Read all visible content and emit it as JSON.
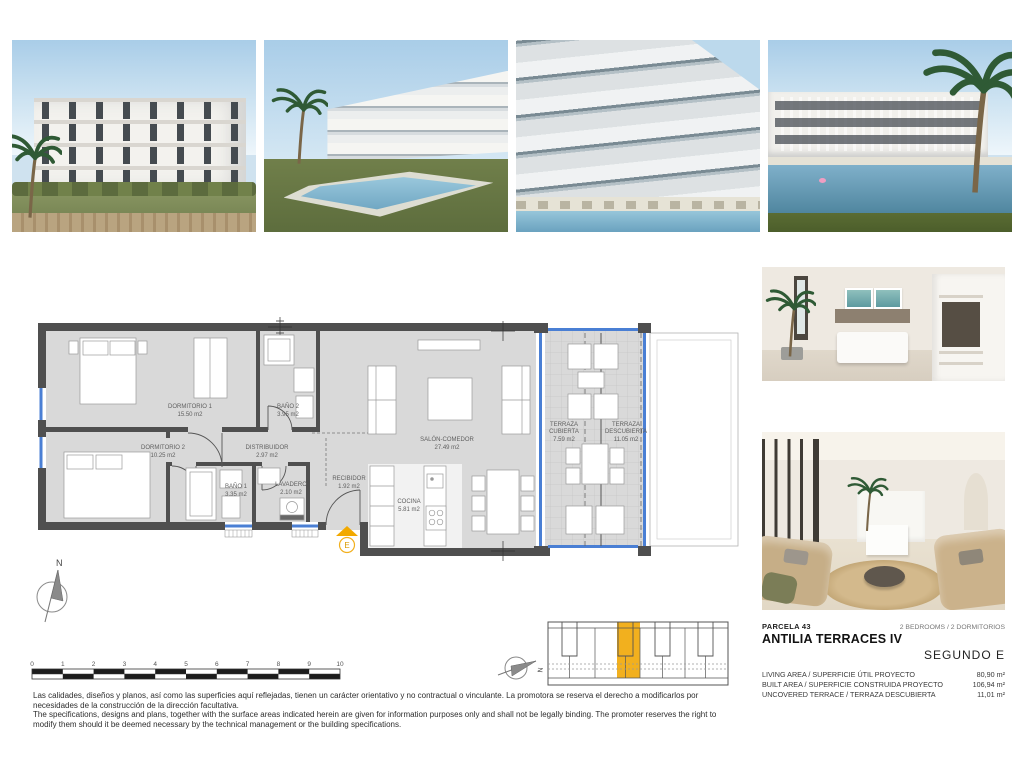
{
  "colors": {
    "accent_yellow": "#f2a900",
    "window_blue": "#4a7fd4",
    "wall_gray": "#4f4f4f",
    "floor_gray": "#d9d9d9"
  },
  "floor_plan": {
    "north_label": "N",
    "entrance_label": "E",
    "rooms": [
      {
        "name": "DORMITORIO 1",
        "area": "15.50 m2"
      },
      {
        "name": "DORMITORIO 2",
        "area": "10.25 m2"
      },
      {
        "name": "BAÑO 2",
        "area": "3.95 m2"
      },
      {
        "name": "DISTRIBUIDOR",
        "area": "2.97 m2"
      },
      {
        "name": "BAÑO 1",
        "area": "3.35 m2"
      },
      {
        "name": "LAVADERO",
        "area": "2.10 m2"
      },
      {
        "name": "RECIBIDOR",
        "area": "1.92 m2"
      },
      {
        "name": "COCINA",
        "area": "5.81 m2"
      },
      {
        "name": "SALÓN-COMEDOR",
        "area": "27.49 m2"
      },
      {
        "name": "TERRAZA",
        "name2": "CUBIERTA",
        "area": "7.59 m2"
      },
      {
        "name": "TERRAZA",
        "name2": "DESCUBIERTA",
        "area": "11.05 m2"
      }
    ]
  },
  "scale_bar": {
    "ticks": [
      "0",
      "1",
      "2",
      "3",
      "4",
      "5",
      "6",
      "7",
      "8",
      "9",
      "10"
    ]
  },
  "key_plan": {
    "north_label": "N"
  },
  "info_panel": {
    "parcel": "PARCELA  43",
    "bedrooms": "2 BEDROOMS / 2 DORMITORIOS",
    "project": "ANTILIA TERRACES IV",
    "unit": "SEGUNDO  E",
    "rows": [
      {
        "label": "LIVING AREA / SUPERFICIE ÚTIL PROYECTO",
        "value": "80,90 m²"
      },
      {
        "label": "BUILT AREA / SUPERFICIE CONSTRUIDA PROYECTO",
        "value": "106,94 m²"
      },
      {
        "label": "UNCOVERED TERRACE / TERRAZA DESCUBIERTA",
        "value": "11,01 m²"
      }
    ]
  },
  "disclaimer": {
    "es": "Las calidades, diseños y planos, así como las superficies aquí reflejadas, tienen un carácter orientativo y no contractual o vinculante. La promotora se reserva el derecho a modificarlos por necesidades de la construcción de la dirección facultativa.",
    "en": "The specifications, designs and plans, together with the surface areas indicated herein are given for information purposes only and shall not be legally binding. The promoter reserves the right to modify them should it be deemed necessary by the technical management or the building specifications."
  }
}
